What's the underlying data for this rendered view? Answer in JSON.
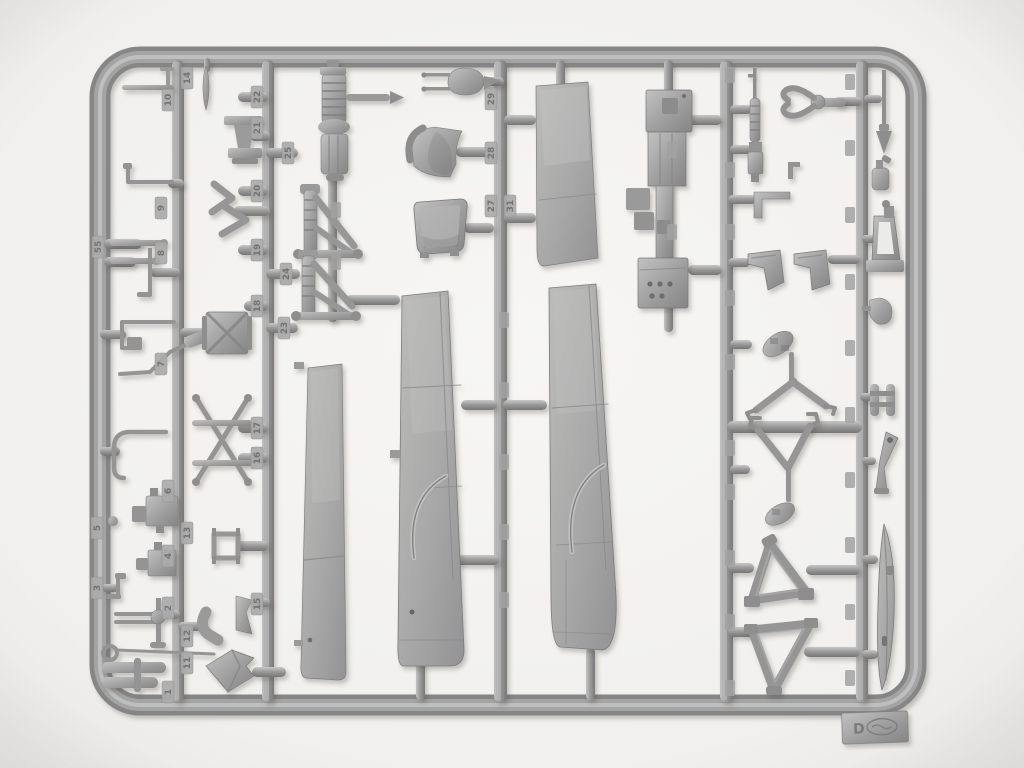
{
  "meta": {
    "description": "Photograph of a grey styrene injection-moulded model aircraft sprue (parts tree) on a white background: rectangular rounded frame, vertical runners, wing panels, seats, struts, machine gun, engine parts; embossed part-number tabs",
    "object": "model-kit-sprue"
  },
  "colors": {
    "background": "#f5f4f2",
    "background_edge": "#e8e7e5",
    "plastic_light": "#c6c6c6",
    "plastic_mid": "#9c9c9c",
    "plastic_dark": "#747474",
    "emboss_text": "#6e6e6e",
    "shadow": "rgba(70,65,60,0.35)"
  },
  "sprue": {
    "tag_letter": "D",
    "part_numbers": [
      "14",
      "10",
      "22",
      "21",
      "25",
      "20",
      "9",
      "19",
      "8",
      "24",
      "18",
      "23",
      "7",
      "17",
      "16",
      "55",
      "29",
      "28",
      "27",
      "31",
      "6",
      "13",
      "5",
      "4",
      "3",
      "2",
      "12",
      "15",
      "11",
      "1"
    ]
  }
}
